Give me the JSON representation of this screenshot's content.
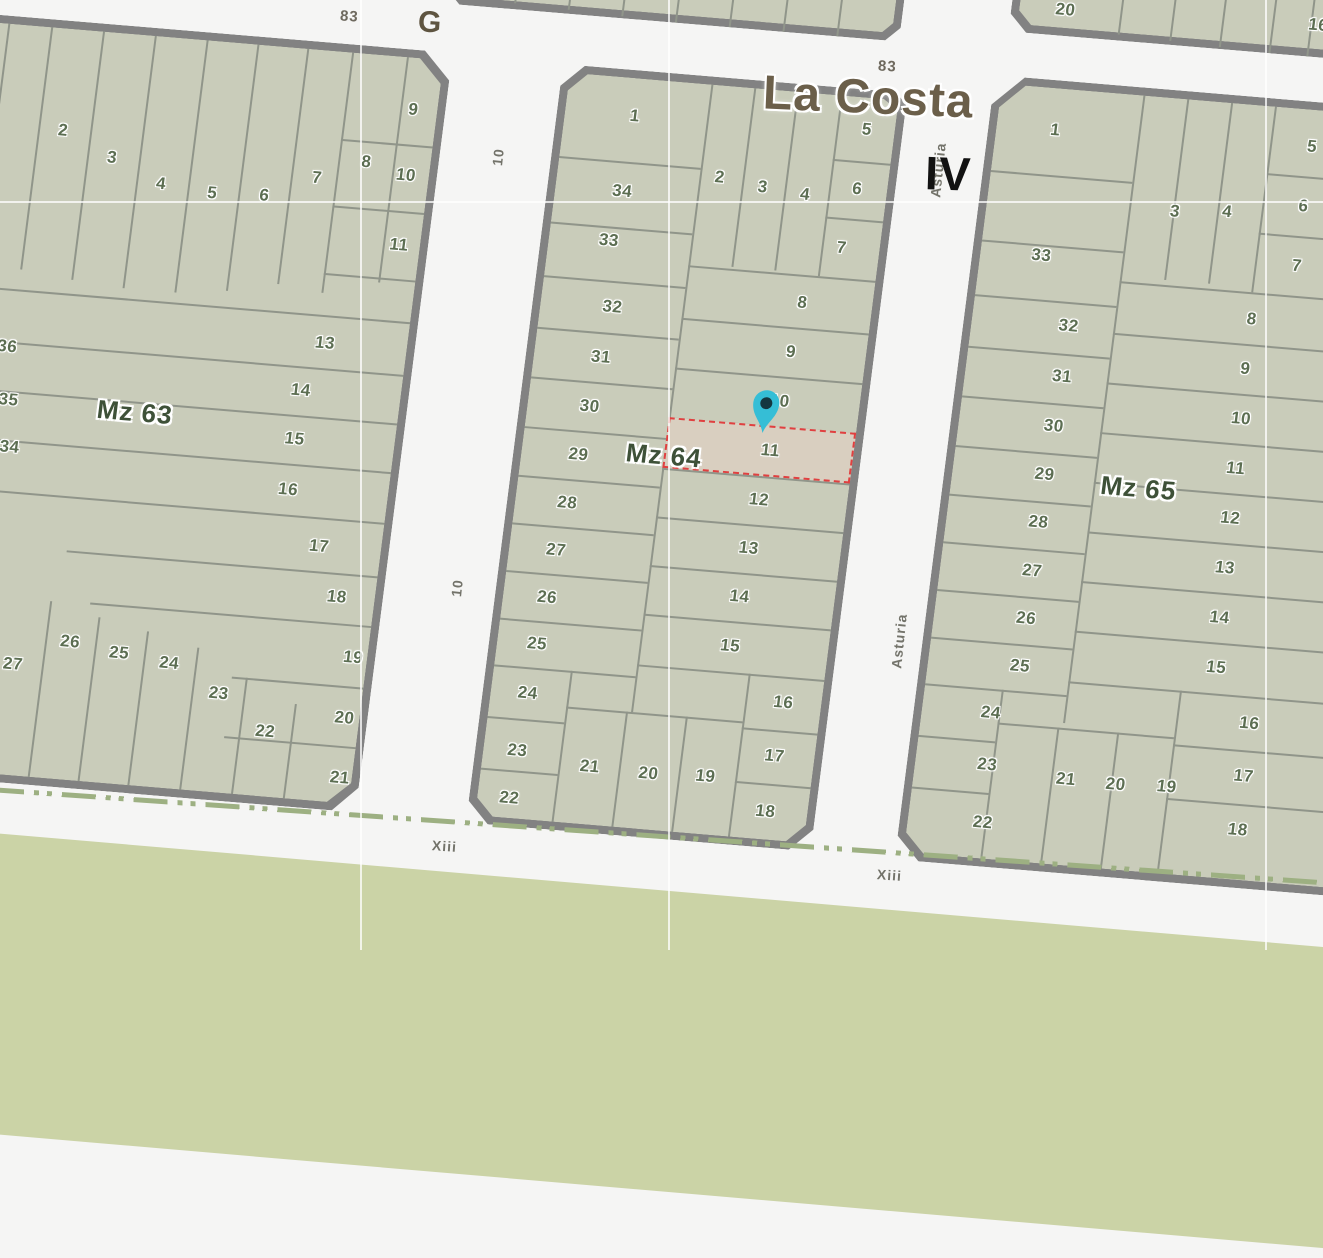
{
  "map": {
    "place_label": "La Costa",
    "sector_label": "IV",
    "streets": {
      "g": "G",
      "route_top_left": "83",
      "route_top_right": "83",
      "ten_upper": "10",
      "ten_lower": "10",
      "asturia": "Asturia",
      "asturia_fragment": "ia",
      "xiii_left": "Xiii",
      "xiii_mid": "Xiii",
      "xiii_right": "Xiii"
    },
    "marker": {
      "type": "map-pin",
      "block": "Mz 64",
      "on_parcel": "11"
    },
    "colors": {
      "parcel_fill": "#c9ccba",
      "block_border": "#828282",
      "parcel_line": "#90958a",
      "street_bg": "#f5f5f4",
      "green_area": "#cbd3a6",
      "dash_line": "#9db082",
      "parcel_number": "#5c6e52",
      "mz_label": "#3e5138",
      "place_text": "#6b5f4a",
      "sector_text": "#121212",
      "street_text": "#73736a",
      "highlight_fill": "#d9cfc0",
      "highlight_border": "#e04040",
      "pin_body": "#35bed6",
      "pin_dot": "#143740"
    },
    "blocks": {
      "mz63": {
        "label": "Mz 63",
        "label_pos": {
          "x": 350,
          "y": 385
        },
        "parcels": [
          {
            "t": "2",
            "x": 243,
            "y": 110
          },
          {
            "t": "3",
            "x": 295,
            "y": 133
          },
          {
            "t": "4",
            "x": 347,
            "y": 155
          },
          {
            "t": "5",
            "x": 399,
            "y": 160
          },
          {
            "t": "6",
            "x": 451,
            "y": 158
          },
          {
            "t": "7",
            "x": 501,
            "y": 136
          },
          {
            "t": "8",
            "x": 548,
            "y": 116
          },
          {
            "t": "9",
            "x": 588,
            "y": 60
          },
          {
            "t": "10",
            "x": 589,
            "y": 126
          },
          {
            "t": "11",
            "x": 591,
            "y": 196
          },
          {
            "t": "13",
            "x": 530,
            "y": 300
          },
          {
            "t": "14",
            "x": 512,
            "y": 349
          },
          {
            "t": "15",
            "x": 512,
            "y": 398
          },
          {
            "t": "16",
            "x": 512,
            "y": 449
          },
          {
            "t": "17",
            "x": 550,
            "y": 503
          },
          {
            "t": "18",
            "x": 574,
            "y": 552
          },
          {
            "t": "19",
            "x": 598,
            "y": 611
          },
          {
            "t": "20",
            "x": 597,
            "y": 672
          },
          {
            "t": "21",
            "x": 600,
            "y": 732
          },
          {
            "t": "22",
            "x": 520,
            "y": 692
          },
          {
            "t": "23",
            "x": 469,
            "y": 658
          },
          {
            "t": "24",
            "x": 416,
            "y": 632
          },
          {
            "t": "25",
            "x": 365,
            "y": 626
          },
          {
            "t": "26",
            "x": 315,
            "y": 619
          },
          {
            "t": "27",
            "x": 261,
            "y": 646
          },
          {
            "t": "34",
            "x": 230,
            "y": 430
          },
          {
            "t": "35",
            "x": 223,
            "y": 383
          },
          {
            "t": "36",
            "x": 215,
            "y": 330
          }
        ]
      },
      "mz64": {
        "label": "Mz 64",
        "label_pos": {
          "x": 150,
          "y": 382
        },
        "highlighted_parcel": "11",
        "parcels": [
          {
            "t": "1",
            "x": 78,
            "y": 46
          },
          {
            "t": "34",
            "x": 75,
            "y": 122
          },
          {
            "t": "33",
            "x": 68,
            "y": 172
          },
          {
            "t": "32",
            "x": 80,
            "y": 238
          },
          {
            "t": "31",
            "x": 75,
            "y": 289
          },
          {
            "t": "30",
            "x": 70,
            "y": 339
          },
          {
            "t": "29",
            "x": 65,
            "y": 388
          },
          {
            "t": "28",
            "x": 60,
            "y": 437
          },
          {
            "t": "27",
            "x": 55,
            "y": 485
          },
          {
            "t": "26",
            "x": 52,
            "y": 533
          },
          {
            "t": "25",
            "x": 48,
            "y": 580
          },
          {
            "t": "24",
            "x": 45,
            "y": 630
          },
          {
            "t": "23",
            "x": 42,
            "y": 688
          },
          {
            "t": "22",
            "x": 40,
            "y": 736
          },
          {
            "t": "2",
            "x": 170,
            "y": 100
          },
          {
            "t": "3",
            "x": 214,
            "y": 106
          },
          {
            "t": "4",
            "x": 257,
            "y": 110
          },
          {
            "t": "5",
            "x": 310,
            "y": 40
          },
          {
            "t": "6",
            "x": 308,
            "y": 100
          },
          {
            "t": "7",
            "x": 300,
            "y": 160
          },
          {
            "t": "8",
            "x": 268,
            "y": 218
          },
          {
            "t": "9",
            "x": 263,
            "y": 268
          },
          {
            "t": "10",
            "x": 258,
            "y": 318
          },
          {
            "t": "11",
            "x": 255,
            "y": 368
          },
          {
            "t": "12",
            "x": 250,
            "y": 418
          },
          {
            "t": "13",
            "x": 246,
            "y": 467
          },
          {
            "t": "14",
            "x": 243,
            "y": 516
          },
          {
            "t": "15",
            "x": 240,
            "y": 566
          },
          {
            "t": "16",
            "x": 300,
            "y": 618
          },
          {
            "t": "17",
            "x": 298,
            "y": 672
          },
          {
            "t": "18",
            "x": 296,
            "y": 728
          },
          {
            "t": "19",
            "x": 232,
            "y": 698
          },
          {
            "t": "20",
            "x": 175,
            "y": 700
          },
          {
            "t": "21",
            "x": 116,
            "y": 698
          }
        ]
      },
      "mz65": {
        "label": "Mz 65",
        "label_pos": {
          "x": 195,
          "y": 400
        },
        "parcels": [
          {
            "t": "1",
            "x": 67,
            "y": 50
          },
          {
            "t": "33",
            "x": 69,
            "y": 176
          },
          {
            "t": "32",
            "x": 105,
            "y": 244
          },
          {
            "t": "31",
            "x": 105,
            "y": 295
          },
          {
            "t": "30",
            "x": 103,
            "y": 345
          },
          {
            "t": "29",
            "x": 100,
            "y": 394
          },
          {
            "t": "28",
            "x": 100,
            "y": 442
          },
          {
            "t": "27",
            "x": 100,
            "y": 491
          },
          {
            "t": "26",
            "x": 100,
            "y": 539
          },
          {
            "t": "25",
            "x": 100,
            "y": 587
          },
          {
            "t": "24",
            "x": 77,
            "y": 636
          },
          {
            "t": "23",
            "x": 80,
            "y": 688
          },
          {
            "t": "22",
            "x": 83,
            "y": 746
          },
          {
            "t": "3",
            "x": 196,
            "y": 121
          },
          {
            "t": "4",
            "x": 248,
            "y": 117
          },
          {
            "t": "5",
            "x": 324,
            "y": 45
          },
          {
            "t": "6",
            "x": 323,
            "y": 105
          },
          {
            "t": "7",
            "x": 324,
            "y": 165
          },
          {
            "t": "8",
            "x": 286,
            "y": 222
          },
          {
            "t": "9",
            "x": 286,
            "y": 272
          },
          {
            "t": "10",
            "x": 288,
            "y": 322
          },
          {
            "t": "11",
            "x": 289,
            "y": 372
          },
          {
            "t": "12",
            "x": 290,
            "y": 422
          },
          {
            "t": "13",
            "x": 291,
            "y": 472
          },
          {
            "t": "14",
            "x": 292,
            "y": 522
          },
          {
            "t": "15",
            "x": 295,
            "y": 572
          },
          {
            "t": "16",
            "x": 335,
            "y": 625
          },
          {
            "t": "17",
            "x": 336,
            "y": 678
          },
          {
            "t": "18",
            "x": 337,
            "y": 732
          },
          {
            "t": "19",
            "x": 261,
            "y": 695
          },
          {
            "t": "20",
            "x": 210,
            "y": 697
          },
          {
            "t": "21",
            "x": 160,
            "y": 696
          }
        ]
      },
      "top_left_block": {
        "label": "",
        "parcels": []
      },
      "top_right_block": {
        "label": "",
        "parcels": [
          {
            "t": "20",
            "x": 54,
            "y": 66
          },
          {
            "t": "16",
            "x": 307,
            "y": 60
          }
        ]
      }
    }
  }
}
